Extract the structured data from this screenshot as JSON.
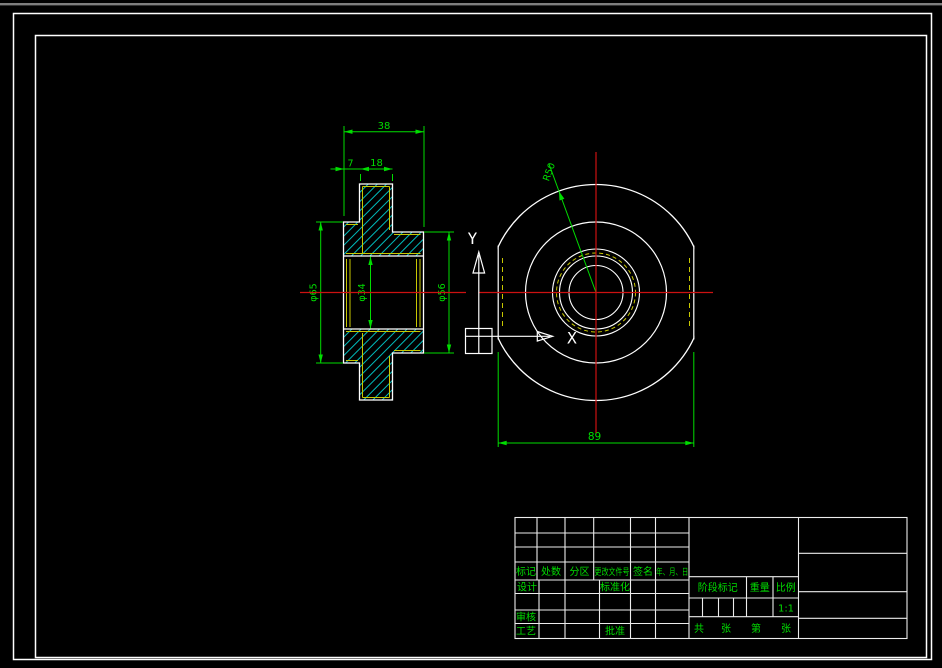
{
  "colors": {
    "background": "#000000",
    "outline": "#ffffff",
    "dimension_green": "#00dd00",
    "hatch_cyan": "#00d2d2",
    "centerline_red": "#cc1111",
    "hidden_yellow": "#c8c800"
  },
  "section_view": {
    "dim_total_length": "38",
    "dim_left_step": "7",
    "dim_hub_length": "18",
    "dim_left_diameter": "φ65",
    "dim_bore_diameter": "φ34",
    "dim_right_diameter": "φ56"
  },
  "front_view": {
    "dim_radius": "R50",
    "dim_across_flats": "89",
    "ucs": {
      "x_label": "X",
      "y_label": "Y"
    }
  },
  "title_block": {
    "header_labels": [
      "标记",
      "处数",
      "分区",
      "更改文件号",
      "签名",
      "年、月、日"
    ],
    "design_label": "设计",
    "standardization_label": "标准化",
    "check_label": "审核",
    "process_label": "工艺",
    "approve_label": "批准",
    "stage_mark_label": "阶段标记",
    "weight_label": "重量",
    "scale_label": "比例",
    "scale_value": "1:1",
    "sheet_total_label": "共",
    "sheet_total_unit": "张",
    "sheet_page_label": "第",
    "sheet_page_unit": "张"
  }
}
